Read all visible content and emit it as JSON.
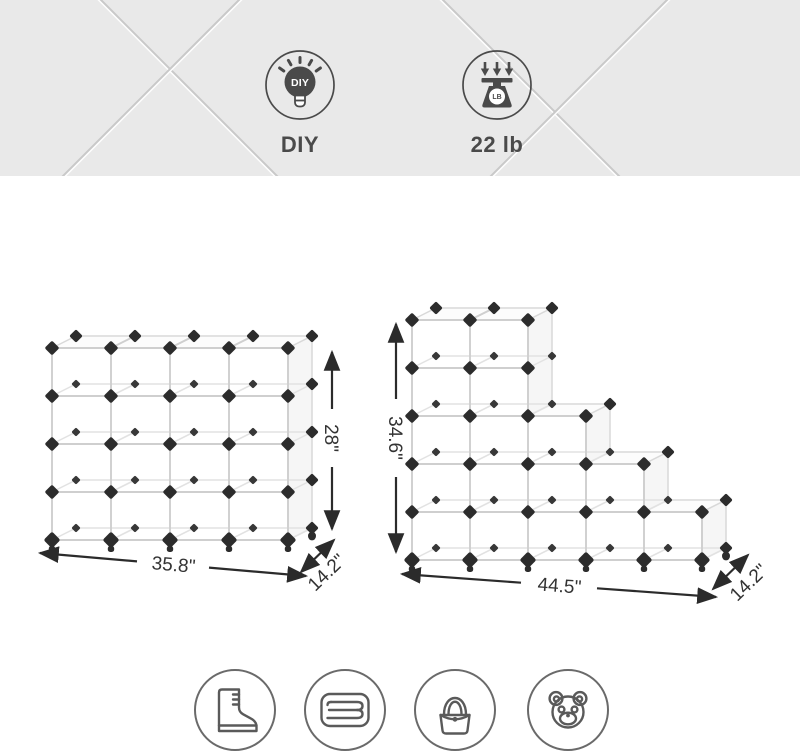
{
  "banner": {
    "features": [
      {
        "icon": "diy-lightbulb-icon",
        "bulb_text": "DIY",
        "label": "DIY"
      },
      {
        "icon": "weight-scale-icon",
        "badge_text": "LB",
        "label": "22 lb"
      }
    ]
  },
  "diagrams": [
    {
      "id": "cube-rack-4x4",
      "cube_columns": [
        4,
        4,
        4,
        4
      ],
      "width_label": "35.8\"",
      "height_label": "28\"",
      "depth_label": "14.2\""
    },
    {
      "id": "cube-rack-staircase",
      "cube_columns": [
        5,
        5,
        3,
        2,
        1
      ],
      "width_label": "44.5\"",
      "height_label": "34.6\"",
      "depth_label": "14.2\""
    }
  ],
  "storage_icons": [
    {
      "name": "boot-icon"
    },
    {
      "name": "folded-towel-icon"
    },
    {
      "name": "handbag-icon"
    },
    {
      "name": "teddy-bear-icon"
    }
  ],
  "colors": {
    "banner_bg": "#e9e9e9",
    "wire_line": "#cfcfcf",
    "connector": "#2c2c2c",
    "dimension": "#2b2b2b",
    "icon_dark": "#4a4a4a",
    "icon_stroke": "#5a5a5a"
  }
}
